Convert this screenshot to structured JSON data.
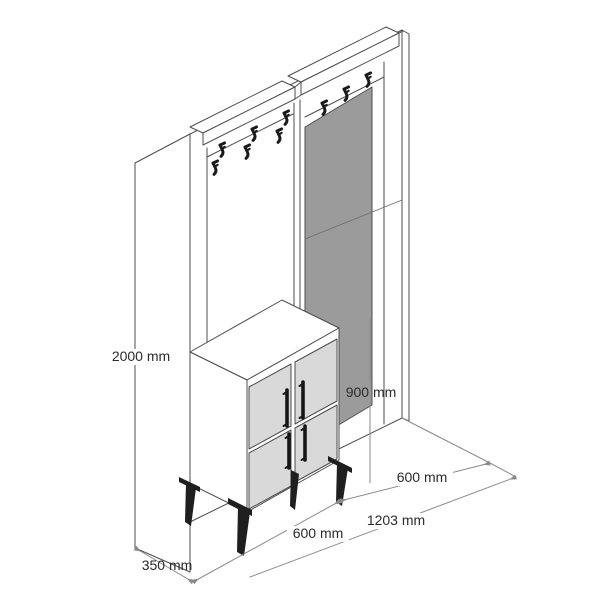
{
  "page": {
    "background": "#ffffff"
  },
  "drawing": {
    "kind": "furniture dimension diagram",
    "subject": "hallway unit with coat hooks, mirror and shoe cabinet",
    "unit": "mm",
    "labels": {
      "total_height": "2000 mm",
      "cabinet_height": "900 mm",
      "depth": "350 mm",
      "cabinet_width": "600 mm",
      "mirror_section_width": "600 mm",
      "total_width": "1203 mm"
    },
    "counts": {
      "coat_hooks": 9,
      "cabinet_doors": 4,
      "door_handles": 4,
      "legs": 4
    },
    "colors": {
      "outline": "#4d4d4d",
      "mirror_fill": "#9b9b9b",
      "door_fill": "#d9d9d9",
      "hardware": "#1a1a1a",
      "dimension_line": "#8a8a8a",
      "label_text": "#2b2b2b"
    }
  }
}
